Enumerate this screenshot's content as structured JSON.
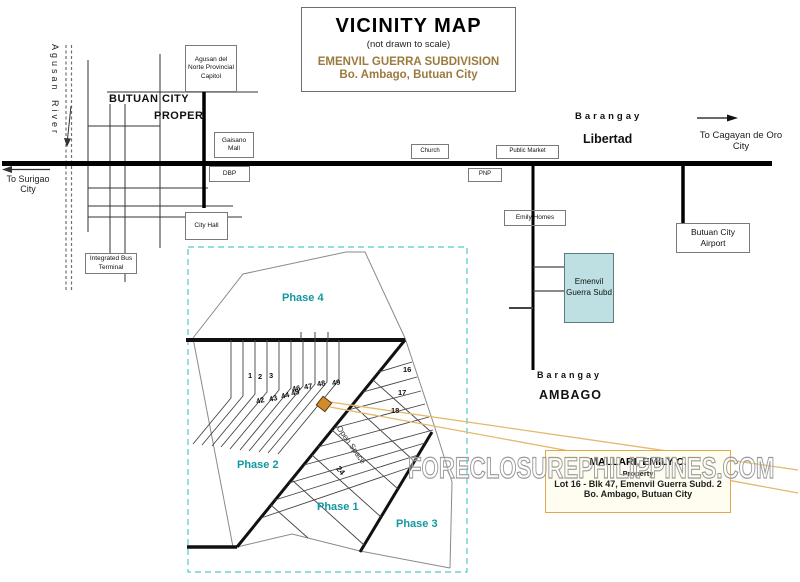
{
  "title_box": {
    "title": "VICINITY MAP",
    "note": "(not drawn to scale)",
    "subdivision": "EMENVIL GUERRA SUBDIVISION",
    "location": "Bo. Ambago, Butuan City"
  },
  "river": {
    "name_top": "Agusan",
    "name_bottom": "River"
  },
  "city": {
    "name": "BUTUAN CITY",
    "proper": "PROPER"
  },
  "roads": {
    "to_surigao": "To Surigao City",
    "to_cagayan": "To Cagayan de Oro City"
  },
  "barangays": {
    "libertad_label": "Barangay",
    "libertad_name": "Libertad",
    "ambago_label": "Barangay",
    "ambago_name": "AMBAGO"
  },
  "places": {
    "capitol": "Agusan del Norte Provincial Capitol",
    "gaisano_mall": "Gaisano Mall",
    "dbp": "DBP",
    "city_hall": "City Hall",
    "bus_terminal": "Integrated Bus Terminal",
    "church": "Church",
    "public_market": "Public Market",
    "pnp": "PNP",
    "emily_homes": "Emily Homes",
    "emenvil_subd": "Emenvil Guerra Subd",
    "airport": "Butuan City Airport"
  },
  "plat": {
    "phase4": "Phase 4",
    "phase2": "Phase 2",
    "phase1": "Phase 1",
    "phase3": "Phase 3",
    "open_space": "Open Space",
    "lots": [
      "1",
      "2",
      "3",
      "42",
      "43",
      "44",
      "45",
      "46",
      "47",
      "48",
      "49",
      "16",
      "17",
      "18",
      "24"
    ]
  },
  "property_box": {
    "owner": "MALLARI, EMILY C.",
    "label": "Property",
    "line1": "Lot 16 - Blk 47, Emenvil Guerra Subd. 2",
    "line2": "Bo. Ambago, Butuan City"
  },
  "watermark": "FORECLOSUREPHILIPPINES.COM",
  "colors": {
    "accent_brown": "#9c7a3e",
    "phase_teal": "#12989e",
    "plat_border_teal": "#55c8cc",
    "subd_fill": "#bfe0e3",
    "marker_orange": "#d38a2c",
    "callout_orange": "#e3b96b",
    "property_border": "#e2a84f",
    "property_bg": "#fffdf0"
  }
}
